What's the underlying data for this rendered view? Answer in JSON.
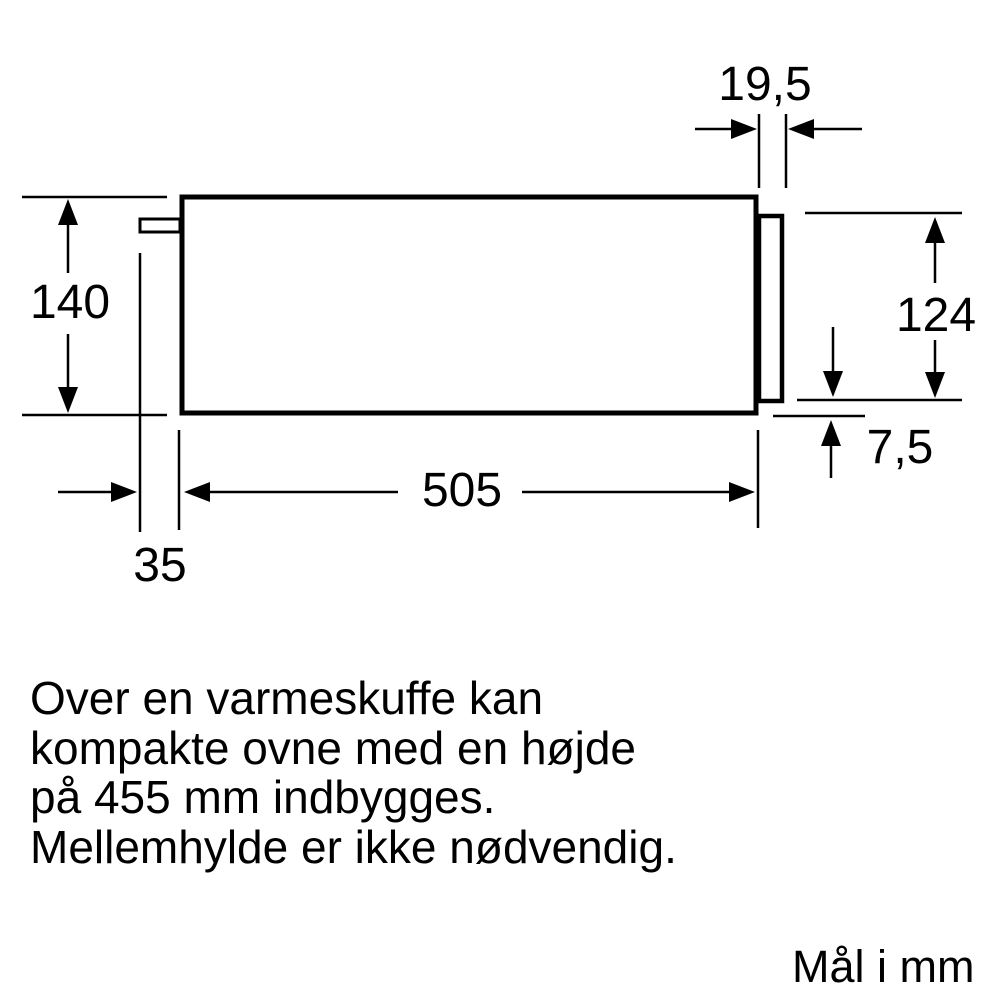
{
  "figure": {
    "kind": "appliance installation dimension drawing",
    "units_label": "Mål i mm",
    "note_text": "Over en varmeskuffe kan\nkompakte ovne med en højde\npå 455 mm indbygges.\nMellemhylde er ikke nødvendig.",
    "dimension_labels": {
      "top_right": "19,5",
      "left": "140",
      "right": "124",
      "right_small": "7,5",
      "bottom_width": "505",
      "bottom_left": "35"
    },
    "colors": {
      "line": "#000000",
      "background": "#ffffff",
      "text": "#000000"
    }
  }
}
